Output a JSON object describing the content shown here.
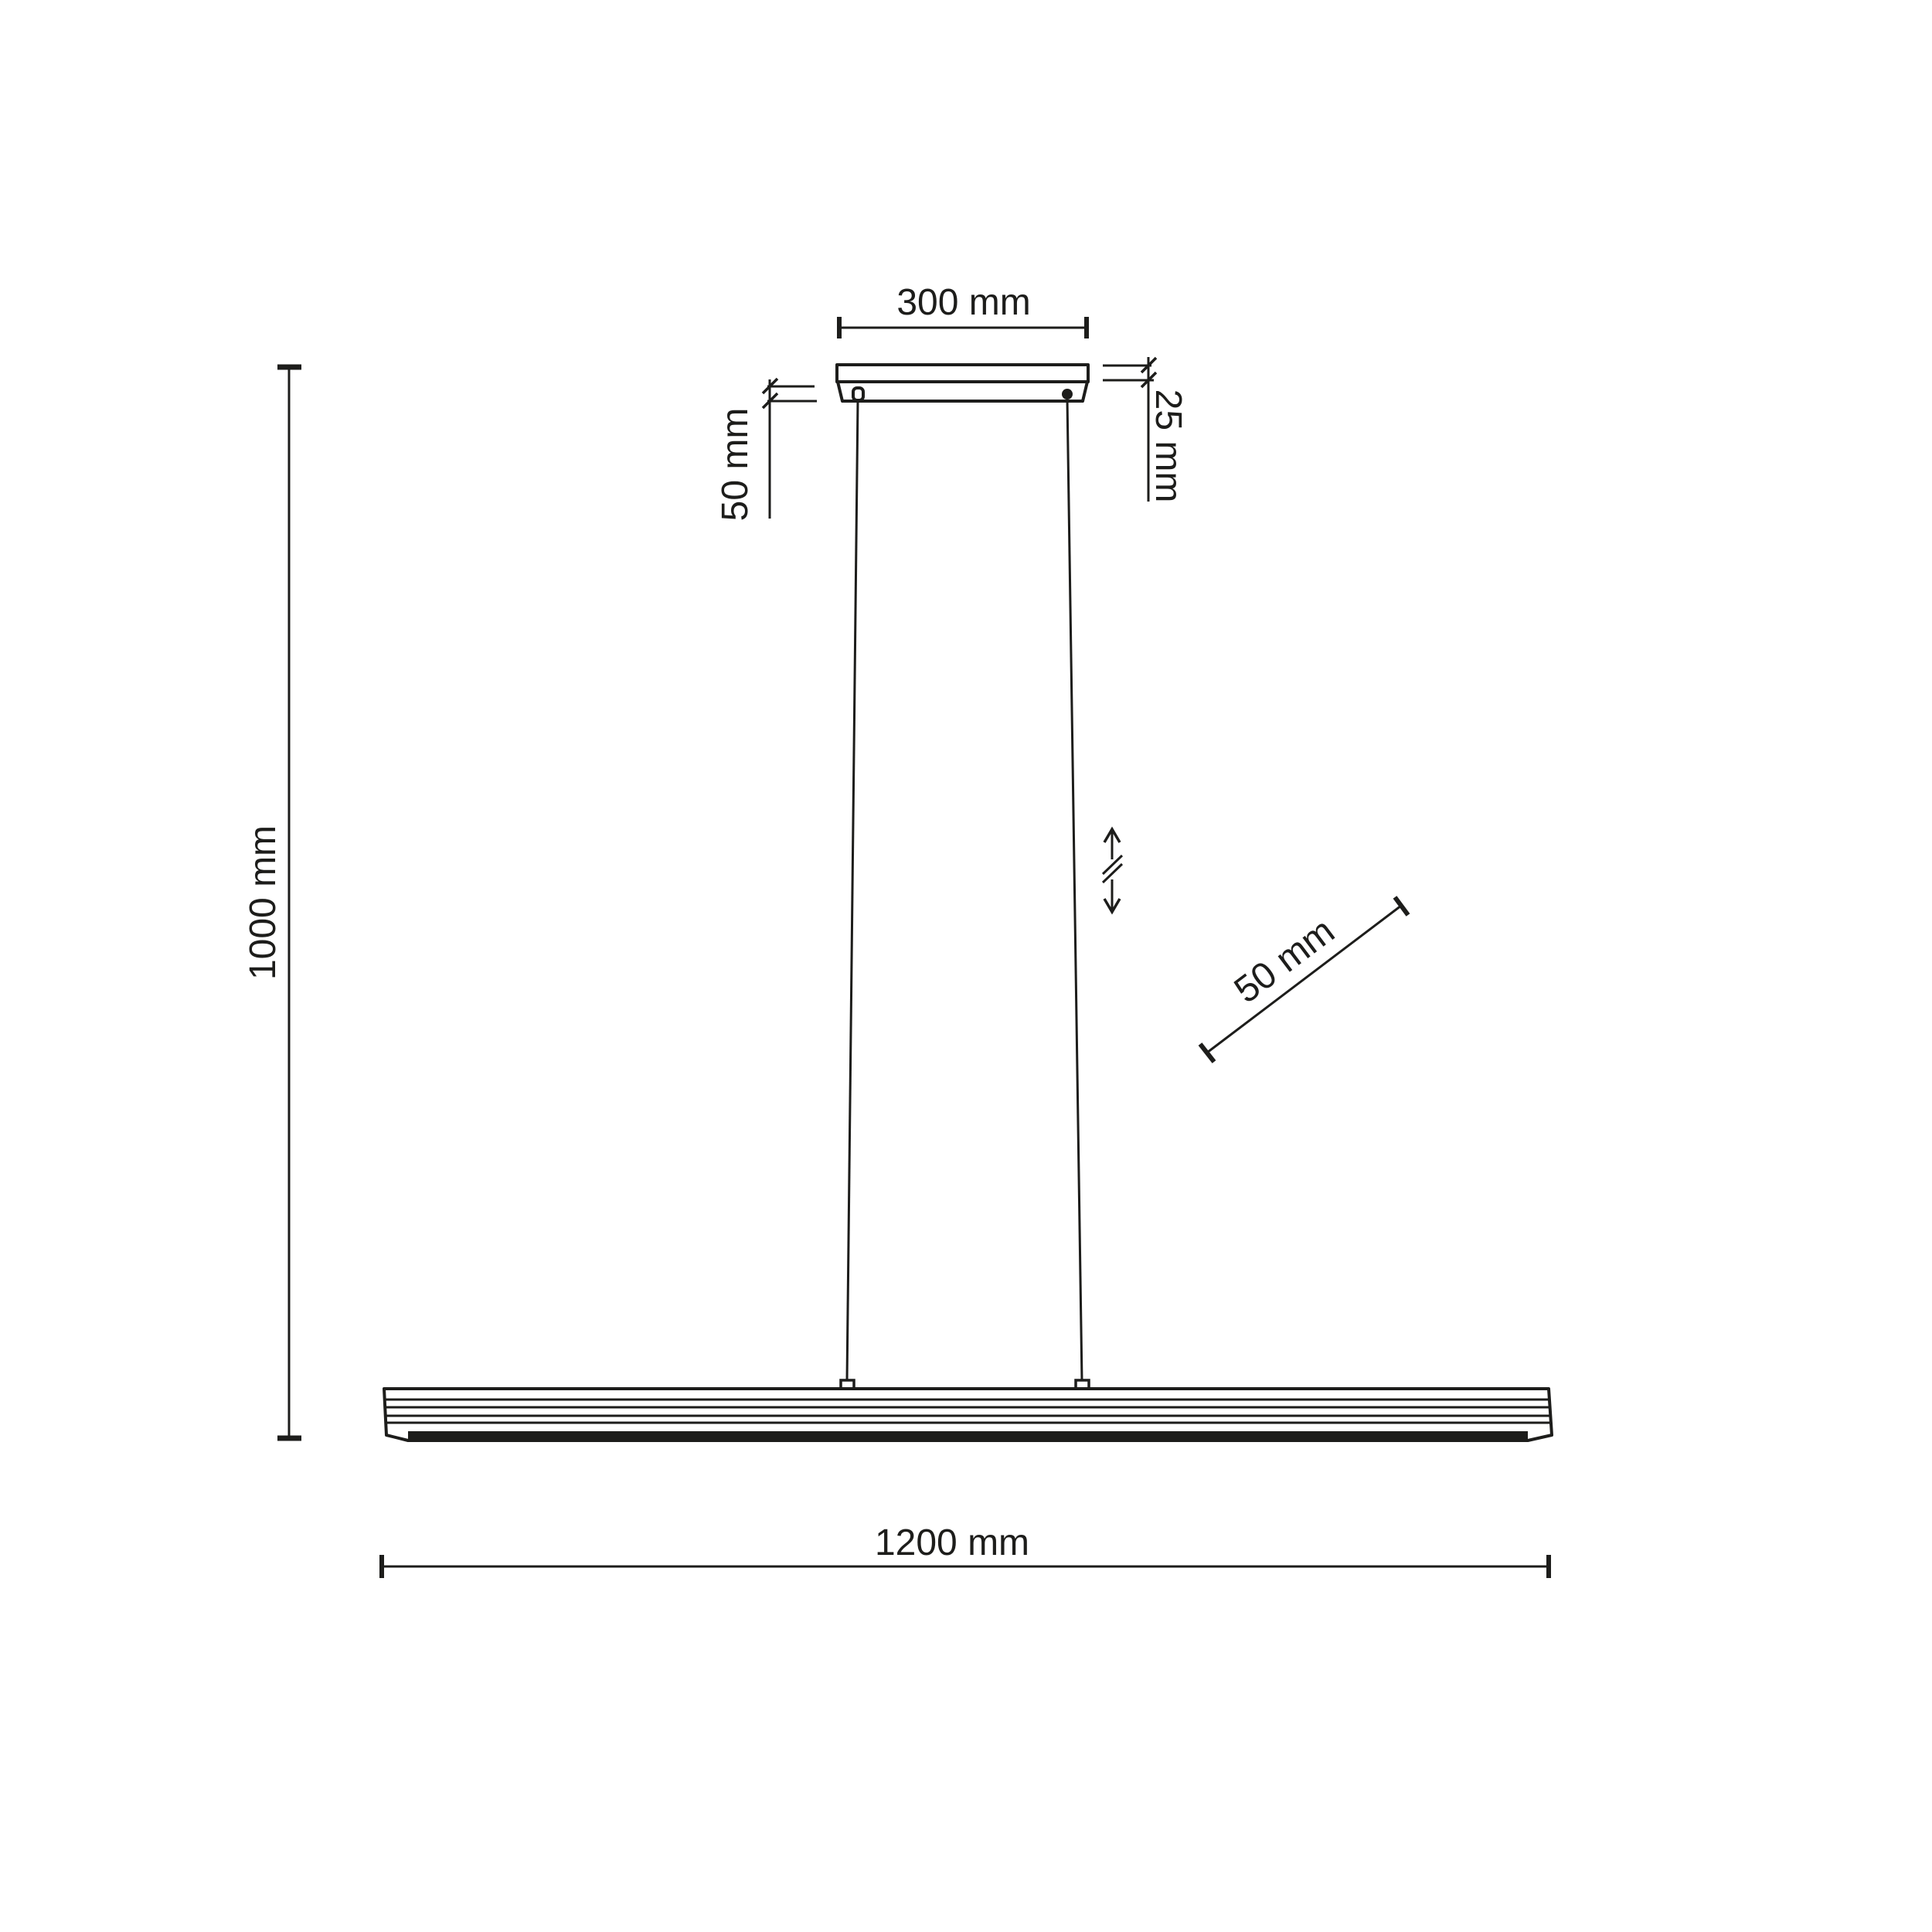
{
  "diagram": {
    "type": "technical-dimension-drawing",
    "subject": "linear-pendant-lamp",
    "background_color": "#ffffff",
    "line_color": "#1d1d1b",
    "unit": "mm",
    "labels": {
      "canopy_width": "300 mm",
      "canopy_thickness": "25 mm",
      "canopy_offset": "50 mm",
      "overall_height": "1000 mm",
      "cable_adjustment": "50 mm",
      "fixture_length": "1200 mm"
    },
    "icons": {
      "height_adjustable": "double-headed-vertical-arrow-with-break"
    }
  }
}
